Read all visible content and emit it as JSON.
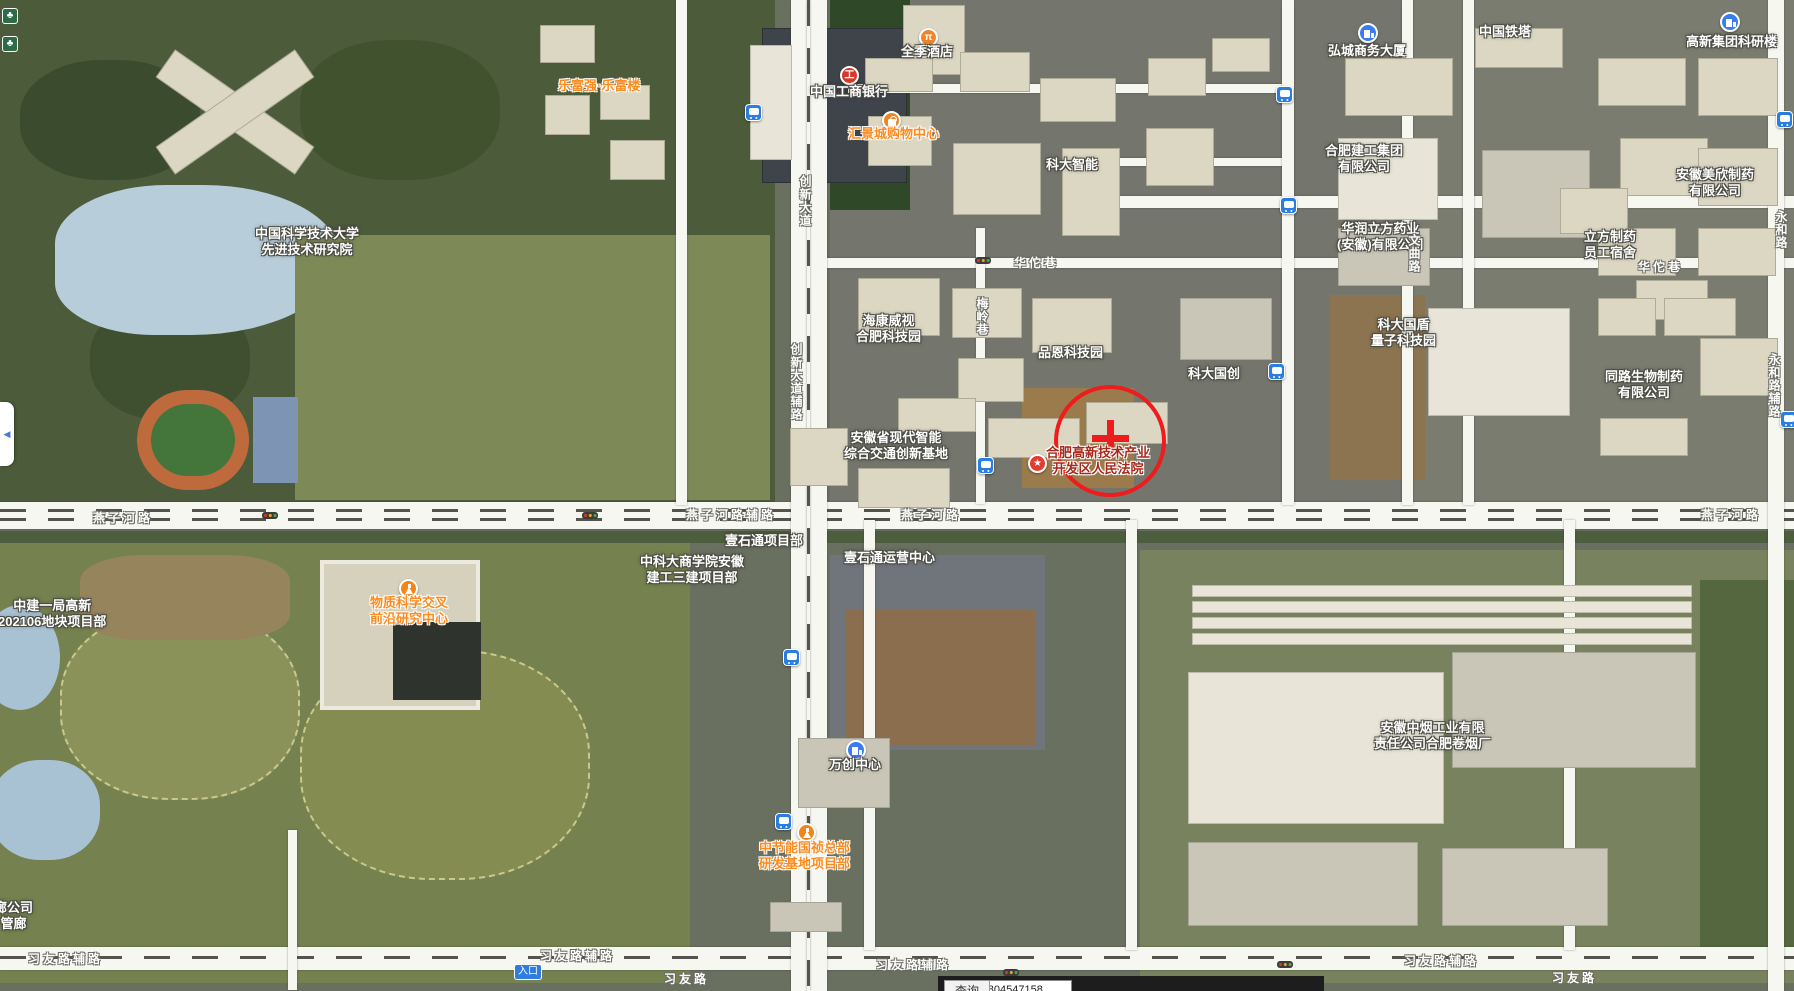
{
  "poi_labels": [
    "中国科学技术大学\n先进技术研究院",
    "全季酒店",
    "中国工商银行",
    "汇景城购物中心",
    "乐富强·乐富楼",
    "科大智能",
    "中国铁塔",
    "弘城商务大厦",
    "高新集团科研楼",
    "合肥建工集团\n有限公司",
    "安徽美欣制药\n有限公司",
    "华润立方药业\n(安徽)有限公司",
    "立方制药\n员工宿舍",
    "海康威视\n合肥科技园",
    "品恩科技园",
    "科大国创",
    "科大国盾\n量子科技园",
    "同路生物制药\n有限公司",
    "安徽省现代智能\n综合交通创新基地",
    "合肥高新技术产业\n开发区人民法院",
    "物质科学交叉\n前沿研究中心",
    "中建一局高新\n202106地块项目部",
    "中科大商学院安徽\n建工三建项目部",
    "壹石通项目部",
    "壹石通运营中心",
    "万创中心",
    "中节能国祯总部\n研发基地项目部",
    "安徽中烟工业有限\n责任公司合肥卷烟厂",
    "廊公司\n管廊"
  ],
  "road_labels": [
    "燕子河路",
    "燕子河路辅路",
    "燕子河路",
    "燕子河路",
    "华佗巷",
    "华佗巷",
    "习友路辅路",
    "习友路辅路",
    "习友路",
    "习友路辅路",
    "习友路辅路",
    "习友路",
    "创新大道",
    "创新大道辅路",
    "梅岭巷",
    "文曲路",
    "永和路",
    "永和路辅路"
  ],
  "tags": {
    "entrance": "入口"
  },
  "glyphs": {
    "collapse_arrow": "◀",
    "court_star": "★",
    "hotel": "π",
    "bank": "工",
    "tree": "♣"
  },
  "statusbar": {
    "lon_label": "经度",
    "lon_value": "117.1270270070507",
    "lat_label": "纬度",
    "lat_value": "31.8250804547158",
    "query_label": "查询"
  },
  "colors": {
    "accent_red": "#ee1c1c",
    "poi_orange": "#ff8a1e",
    "bus_blue": "#2a7de1",
    "court_maroon": "#a8281c"
  }
}
